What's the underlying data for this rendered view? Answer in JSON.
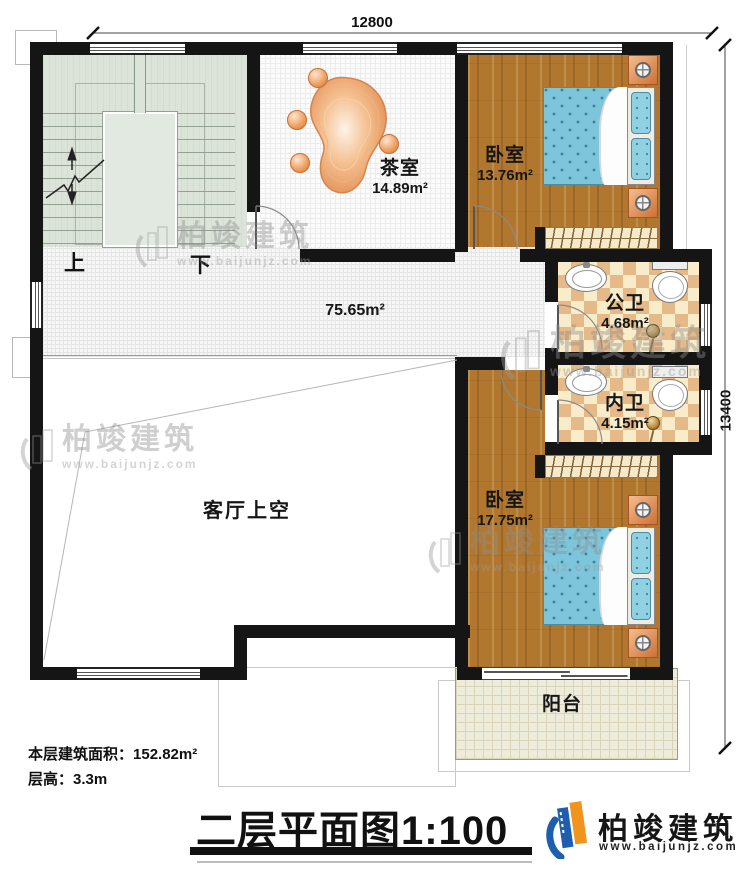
{
  "dims": {
    "width_mm": "12800",
    "height_mm": "13400"
  },
  "stairs": {
    "up": "上",
    "down": "下"
  },
  "rooms": {
    "tea": {
      "name": "茶室",
      "area": "14.89m²"
    },
    "bedroom1": {
      "name": "卧室",
      "area": "13.76m²"
    },
    "public_bath": {
      "name": "公卫",
      "area": "4.68m²"
    },
    "ensuite_bath": {
      "name": "内卫",
      "area": "4.15m²"
    },
    "bedroom2": {
      "name": "卧室",
      "area": "17.75m²"
    },
    "hall": {
      "area": "75.65m²"
    },
    "void": {
      "name": "客厅上空"
    },
    "balcony": {
      "name": "阳台"
    }
  },
  "notes": {
    "floor_area_label": "本层建筑面积：",
    "floor_area_value": "152.82m²",
    "floor_height_label": "层高：",
    "floor_height_value": "3.3m"
  },
  "title": {
    "text": "二层平面图",
    "scale": "1:100"
  },
  "brand": {
    "name": "柏竣建筑",
    "url": "www.baijunjz.com"
  },
  "watermark": {
    "name": "柏竣建筑",
    "url": "www.baijunjz.com"
  },
  "colors": {
    "wall": "#151515",
    "wood": "#b1772e",
    "stair_floor": "#dce4da",
    "tile_dark": "#e5b988",
    "tile_light": "#f8ecca",
    "bed": "#7cc5da",
    "balcony": "#edebd9",
    "accent_blue": "#1d5fae",
    "accent_orange": "#f0941d"
  }
}
